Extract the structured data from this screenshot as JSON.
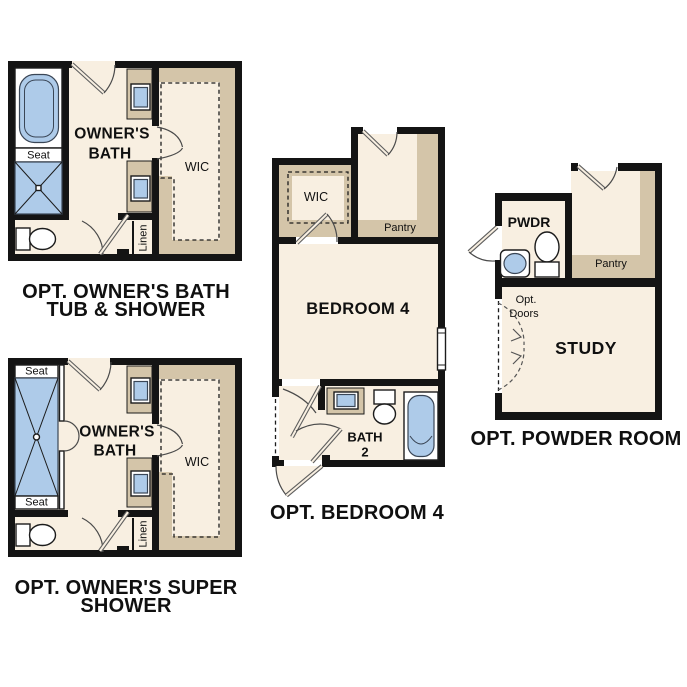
{
  "colors": {
    "wall": "#141414",
    "floor_cream": "#f8efe1",
    "cabinet_tan": "#d4c5a9",
    "fixture_blue": "#aecbe9",
    "background": "#ffffff"
  },
  "plans": {
    "tub_shower": {
      "caption1": "OPT. OWNER'S BATH",
      "caption2": "TUB & SHOWER",
      "room_line1": "OWNER'S",
      "room_line2": "BATH",
      "wic": "WIC",
      "seat": "Seat",
      "linen": "Linen"
    },
    "super_shower": {
      "caption1": "OPT. OWNER'S SUPER",
      "caption2": "SHOWER",
      "room_line1": "OWNER'S",
      "room_line2": "BATH",
      "wic": "WIC",
      "seat_top": "Seat",
      "seat_bottom": "Seat",
      "linen": "Linen"
    },
    "bedroom4": {
      "caption": "OPT. BEDROOM 4",
      "room": "BEDROOM 4",
      "wic": "WIC",
      "pantry": "Pantry",
      "bath_line1": "BATH",
      "bath_line2": "2"
    },
    "powder": {
      "caption": "OPT. POWDER ROOM",
      "pwdr": "PWDR",
      "pantry": "Pantry",
      "study": "STUDY",
      "opt_line1": "Opt.",
      "opt_line2": "Doors"
    }
  }
}
